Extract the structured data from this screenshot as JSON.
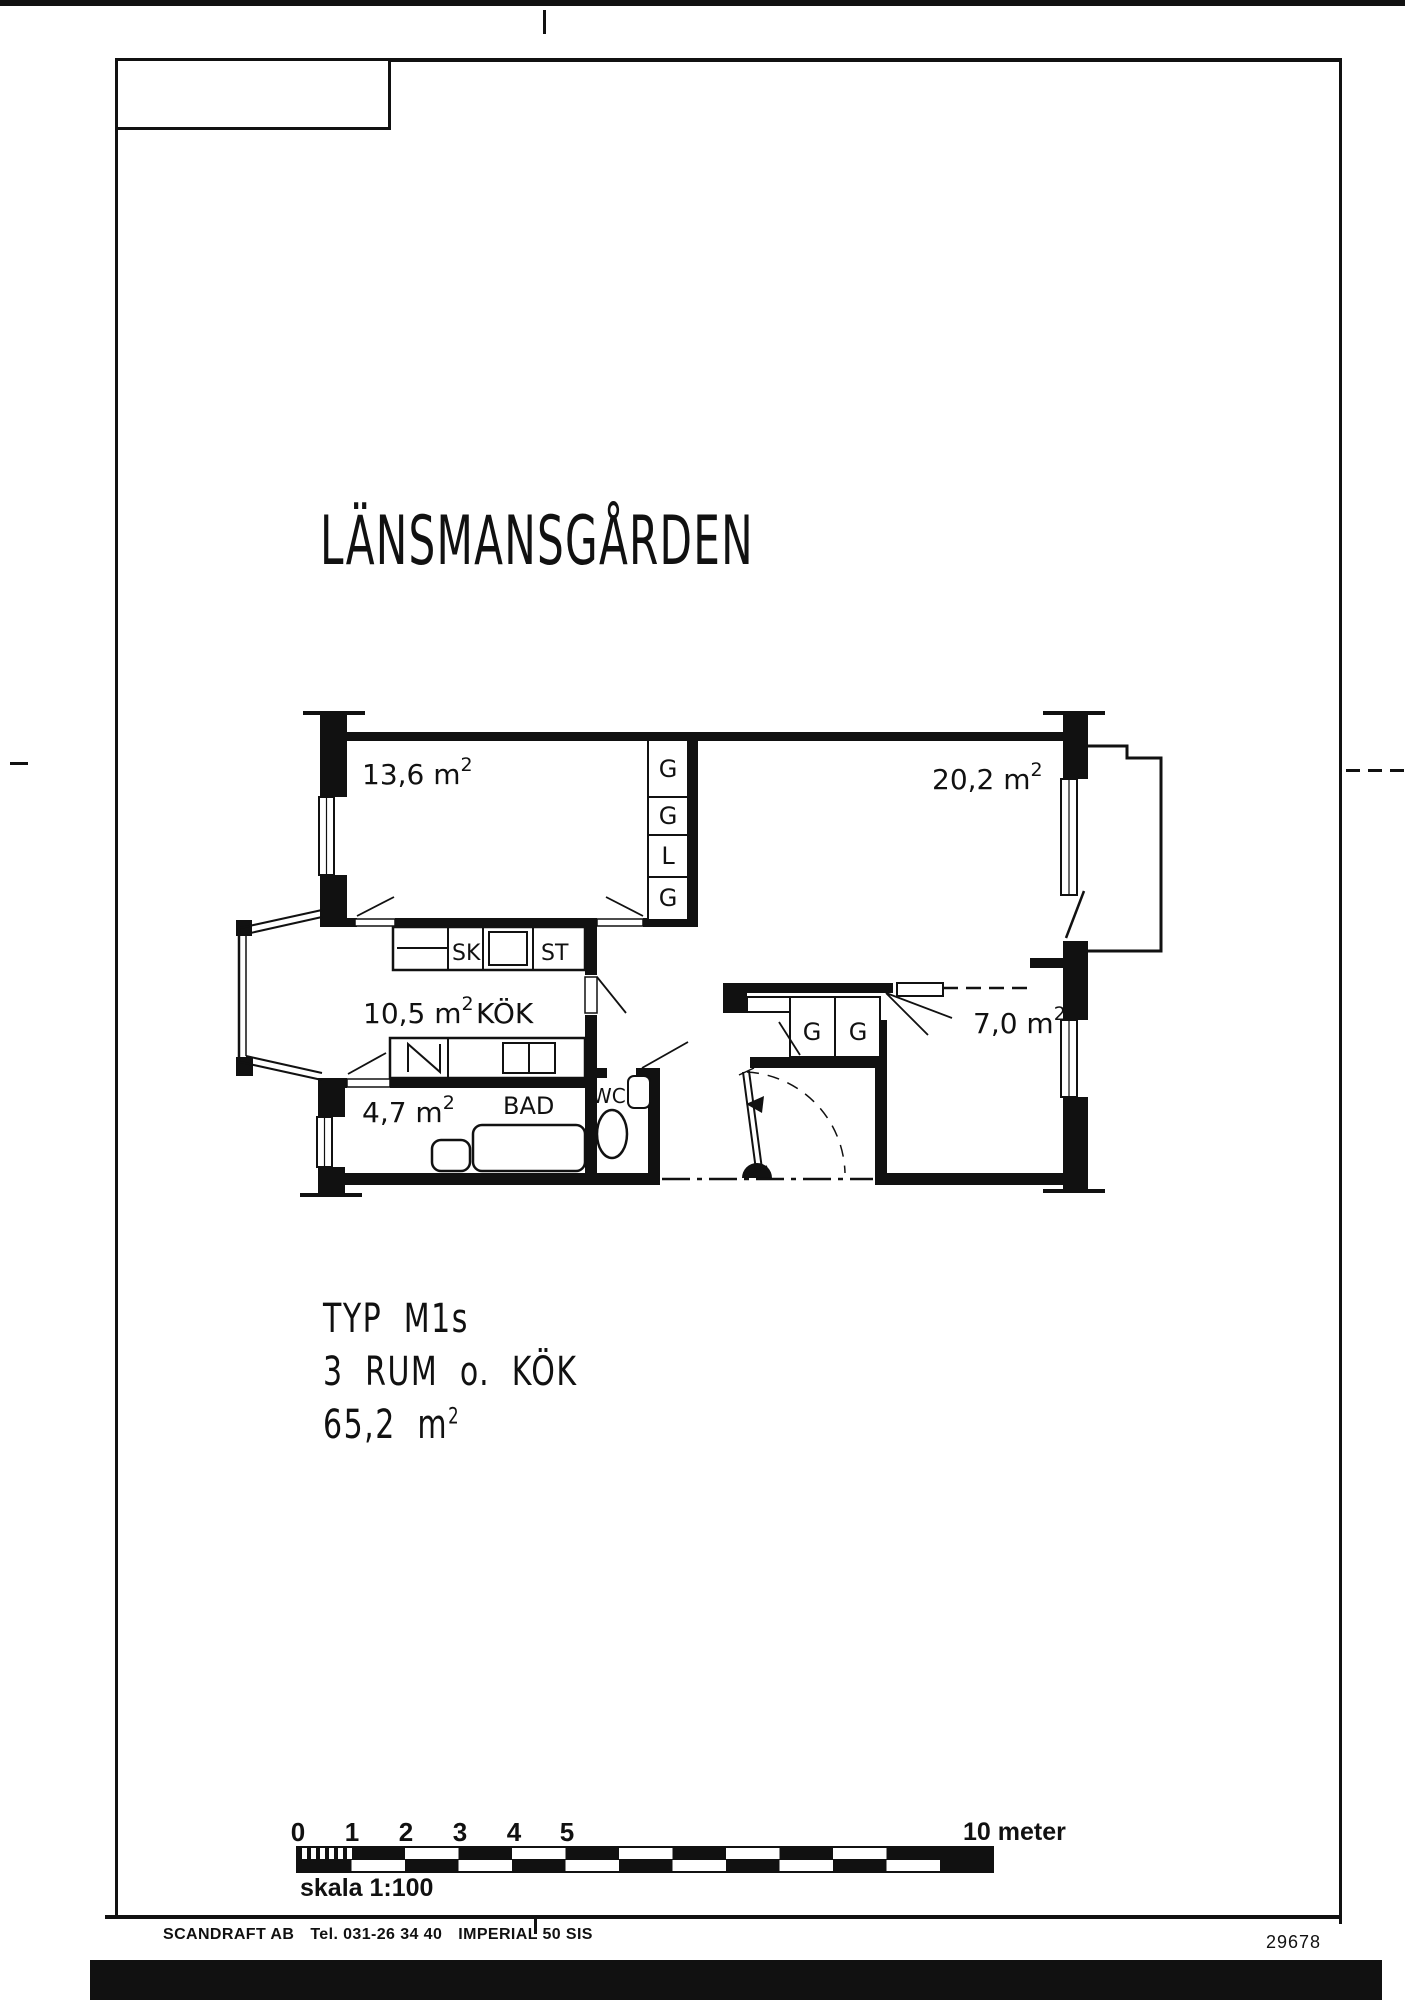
{
  "page": {
    "top_title": "LÄNSMANSGÅRDEN",
    "type_block": {
      "line1": "TYP M1s",
      "line2": "3 RUM o. KÖK",
      "area": "65,2 m",
      "area_sup": "2"
    },
    "footer": {
      "company": "SCANDRAFT AB",
      "phone": "Tel. 031-26 34 40",
      "product": "IMPERIAL 50 SIS",
      "drawing_number": "29678"
    }
  },
  "plan": {
    "rooms": {
      "room1": {
        "area": "13,6 m",
        "sup": "2"
      },
      "room2": {
        "area": "20,2 m",
        "sup": "2"
      },
      "kitchen": {
        "area": "10,5 m",
        "sup": "2",
        "name": "KÖK"
      },
      "bath": {
        "area": "4,7 m",
        "sup": "2",
        "name": "BAD"
      },
      "room3": {
        "area": "7,0 m",
        "sup": "2"
      },
      "wc": {
        "name": "WC"
      }
    },
    "closet_column": [
      "G",
      "G",
      "L",
      "G"
    ],
    "hall_closets": [
      "G",
      "G"
    ],
    "cabinets": {
      "sk": "SK",
      "st": "ST"
    }
  },
  "scale_bar": {
    "ticks": [
      "0",
      "1",
      "2",
      "3",
      "4",
      "5"
    ],
    "end_label": "10 meter",
    "caption": "skala 1:100"
  },
  "colors": {
    "ink": "#111111",
    "paper": "#ffffff"
  }
}
